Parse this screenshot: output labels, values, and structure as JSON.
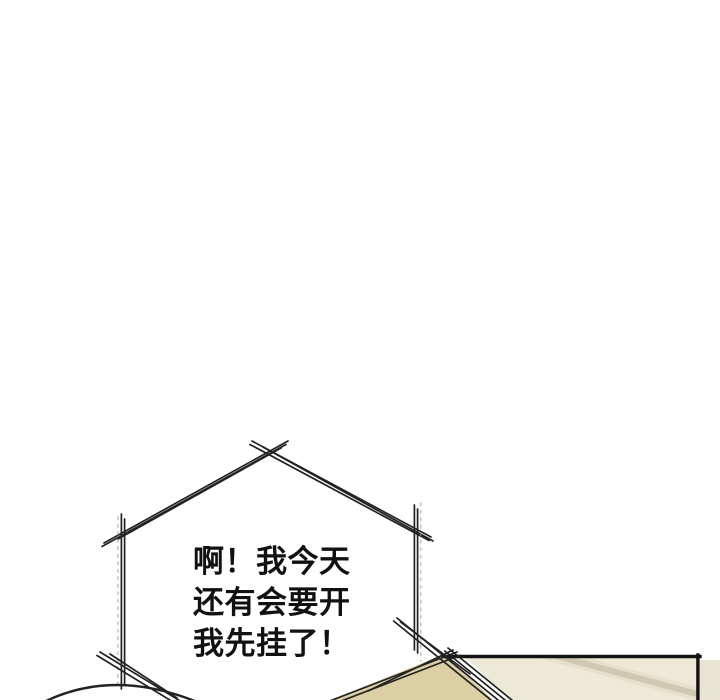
{
  "comic": {
    "speech_bubble": {
      "lines": [
        "啊！我今天",
        "还有会要开",
        "我先挂了！"
      ]
    },
    "colors": {
      "background": "#ffffff",
      "ink": "#222222",
      "sketch_gray": "#999999",
      "panel_border": "#131313",
      "panel_cream": "#eee8d7",
      "panel_cream_edge": "#e9e3d1",
      "panel_tan": "#dccfa3",
      "streak": "#b9ae90"
    }
  }
}
